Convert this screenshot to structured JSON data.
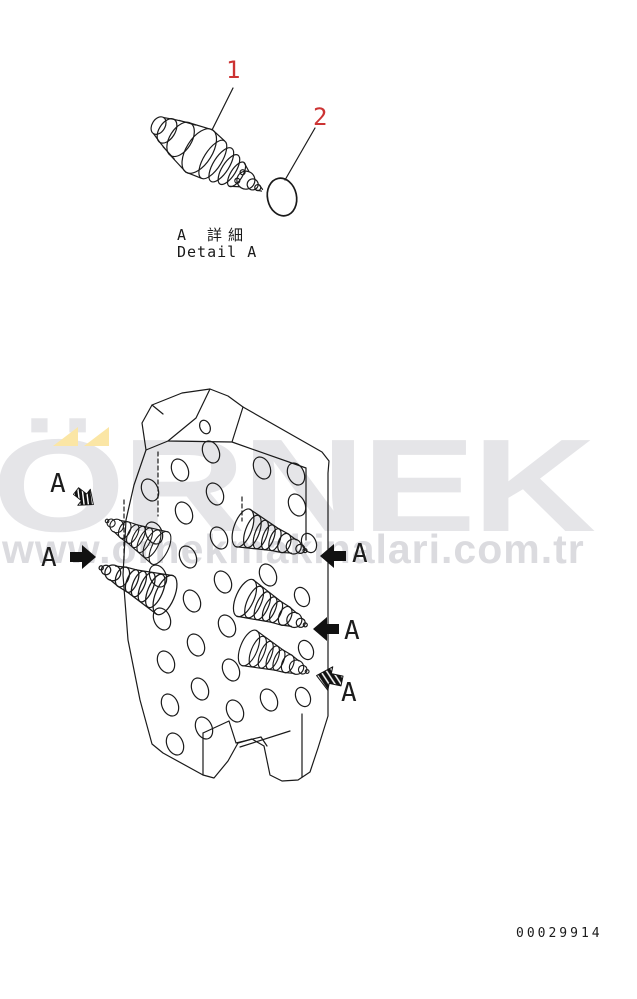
{
  "page": {
    "background_color": "#ffffff",
    "line_color": "#1a1a1a"
  },
  "watermark": {
    "logo_text": "ÖRNEK",
    "url_text": "www.ornekmakinalari.com.tr",
    "logo_color": "#e5e5e8",
    "url_color": "#dbdbdf",
    "accent_yellow": "#fbe6a5"
  },
  "detail_view": {
    "callout_numbers": [
      "1",
      "2"
    ],
    "callout_color": "#cc3333",
    "caption_jp": "A 詳細",
    "caption_en": "Detail A",
    "parts": [
      "solenoid-valve-plug",
      "o-ring"
    ]
  },
  "main_view": {
    "view_arrow_labels": [
      "A",
      "A",
      "A",
      "A",
      "A"
    ],
    "arrow_types": [
      "hatched-down-right",
      "solid-right",
      "solid-left",
      "solid-left",
      "hatched-up-left"
    ]
  },
  "footer": {
    "document_number": "00029914"
  }
}
